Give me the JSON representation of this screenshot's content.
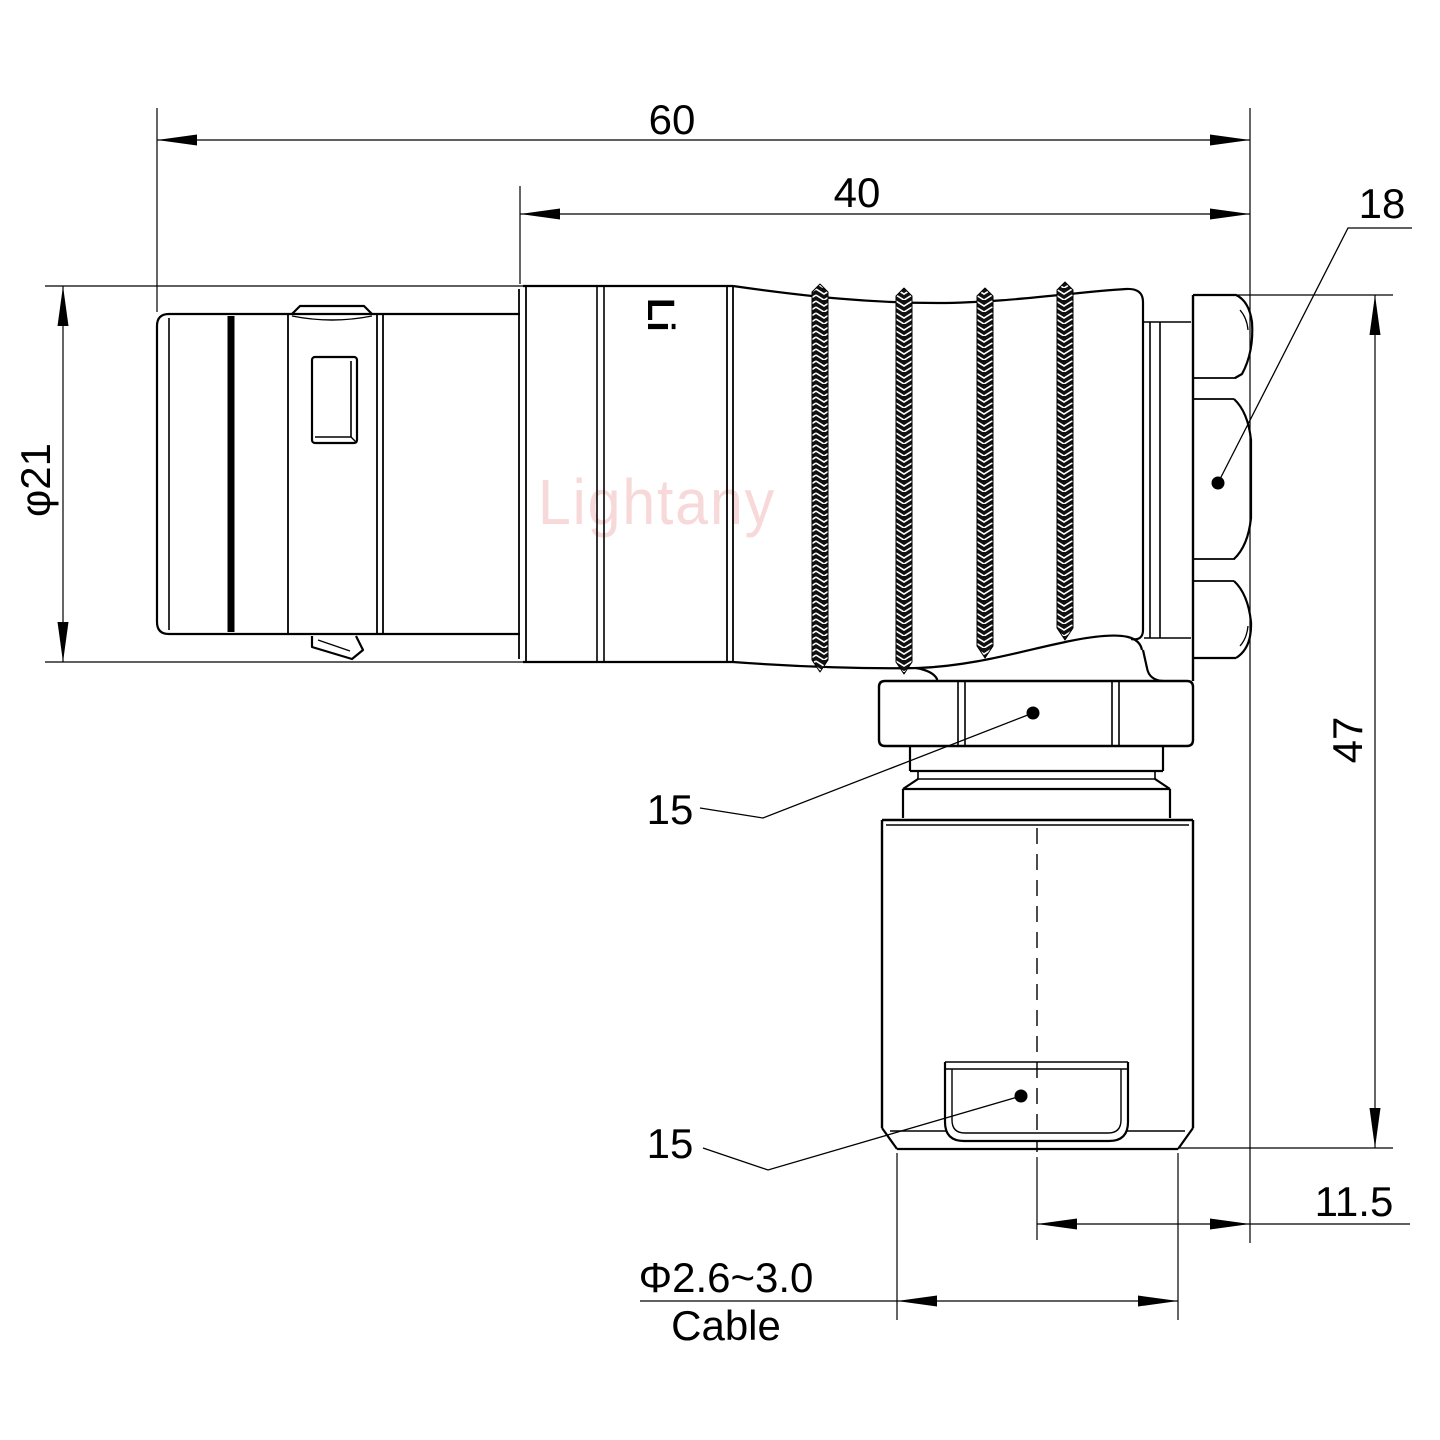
{
  "drawing": {
    "kind": "connector-engineering-drawing",
    "background_color": "#ffffff",
    "line_color": "#000000",
    "watermark": {
      "text": "Lightany",
      "color": "#f7d9d9"
    },
    "partial_logo": "Lig",
    "dimensions": {
      "overall_length": "60",
      "rear_body_length": "40",
      "back_nut_size": "18",
      "shell_diameter": "φ21",
      "elbow_nut_size": "15",
      "cable_tab_size": "15",
      "elbow_height": "47",
      "cable_axis_offset": "11.5",
      "cable_diameter_range": "Φ2.6~3.0",
      "cable_word": "Cable"
    }
  }
}
